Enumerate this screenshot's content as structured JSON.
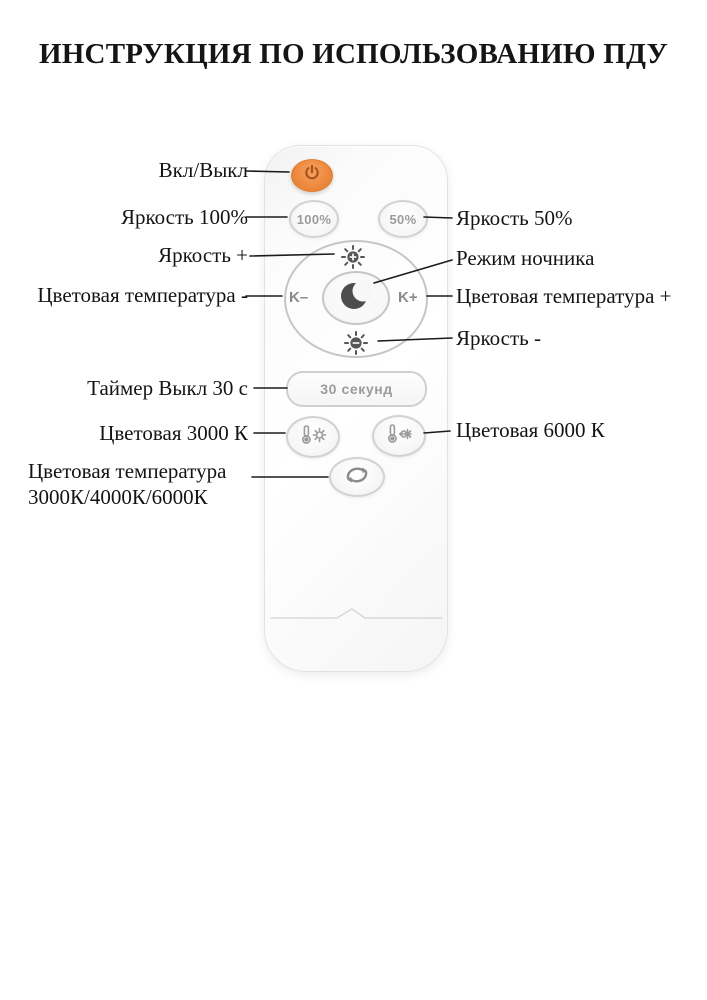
{
  "title": "ИНСТРУКЦИЯ ПО ИСПОЛЬЗОВАНИЮ ПДУ",
  "labels": {
    "power": "Вкл/Выкл",
    "brightness_100": "Яркость 100%",
    "brightness_50": "Яркость 50%",
    "brightness_plus": "Яркость +",
    "night_mode": "Режим ночника",
    "color_temp_minus": "Цветовая температура -",
    "color_temp_plus": "Цветовая температура +",
    "brightness_minus": "Яркость -",
    "timer_off": "Таймер Выкл 30 с",
    "color_3000": "Цветовая 3000 К",
    "color_6000": "Цветовая 6000 К",
    "color_cycle_line1": "Цветовая температура",
    "color_cycle_line2": "3000К/4000К/6000К"
  },
  "remote": {
    "buttons": {
      "brightness_100": "100%",
      "brightness_50": "50%",
      "color_temp_minus": "K–",
      "color_temp_plus": "K+",
      "timer": "30 секунд"
    },
    "icons": {
      "power": "power-symbol",
      "brightness_plus": "sun-plus",
      "brightness_minus": "sun-minus",
      "night_mode": "crescent-moon",
      "color_warm": "thermometer-sun",
      "color_cold": "thermometer-snowflake",
      "color_cycle": "cycle-arrows"
    }
  },
  "colors": {
    "power_button": "#EE8A3E",
    "power_icon": "#A8561E",
    "button_border": "#D2D2D2",
    "button_text": "#9B9B9B",
    "icon_gray": "#999999",
    "moon": "#4D4D4D",
    "annotation_line": "#1B1B1B"
  }
}
